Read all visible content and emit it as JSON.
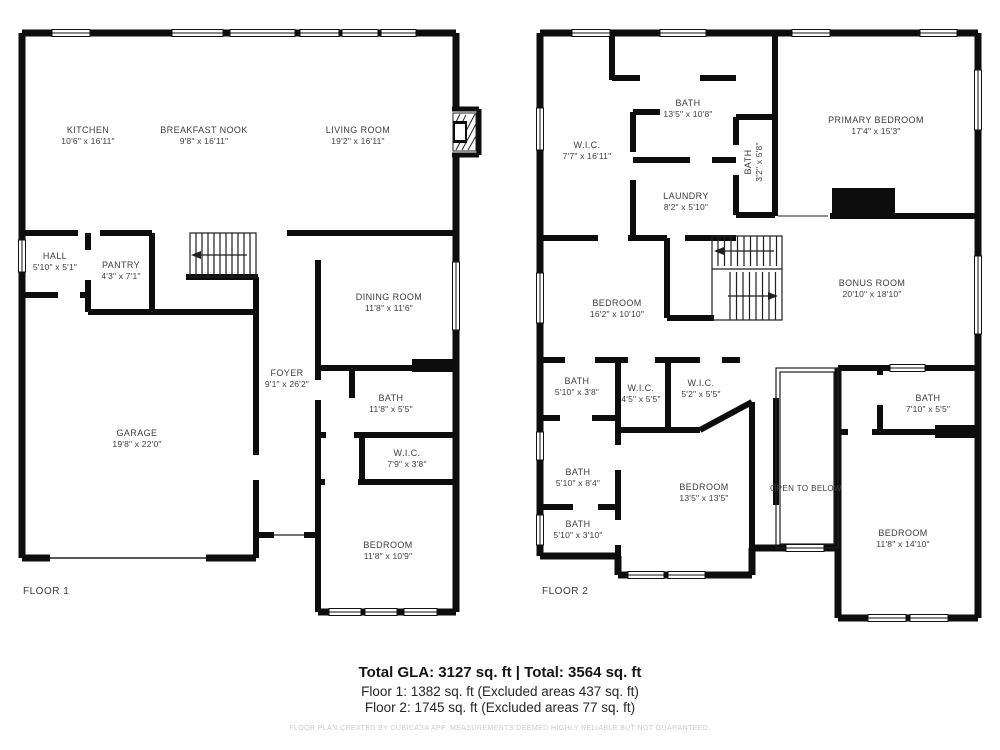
{
  "floor1": {
    "label": "FLOOR 1",
    "rooms": [
      {
        "name": "KITCHEN",
        "dims": "10'6\" x 16'11\""
      },
      {
        "name": "BREAKFAST NOOK",
        "dims": "9'8\" x 16'11\""
      },
      {
        "name": "LIVING ROOM",
        "dims": "19'2\" x 16'11\""
      },
      {
        "name": "HALL",
        "dims": "5'10\" x 5'1\""
      },
      {
        "name": "PANTRY",
        "dims": "4'3\" x 7'1\""
      },
      {
        "name": "DINING ROOM",
        "dims": "11'8\" x 11'6\""
      },
      {
        "name": "FOYER",
        "dims": "9'1\" x 26'2\""
      },
      {
        "name": "BATH",
        "dims": "11'8\" x 5'5\""
      },
      {
        "name": "W.I.C.",
        "dims": "7'9\" x 3'8\""
      },
      {
        "name": "GARAGE",
        "dims": "19'8\" x 22'0\""
      },
      {
        "name": "BEDROOM",
        "dims": "11'8\" x 10'9\""
      }
    ]
  },
  "floor2": {
    "label": "FLOOR 2",
    "open_to_below": "OPEN TO BELOW",
    "rooms": [
      {
        "name": "W.I.C.",
        "dims": "7'7\" x 16'11\""
      },
      {
        "name": "BATH",
        "dims": "13'5\" x 10'8\""
      },
      {
        "name": "BATH",
        "dims": "3'2\" x 5'8\""
      },
      {
        "name": "LAUNDRY",
        "dims": "8'2\" x 5'10\""
      },
      {
        "name": "PRIMARY BEDROOM",
        "dims": "17'4\" x 15'3\""
      },
      {
        "name": "BEDROOM",
        "dims": "16'2\" x 10'10\""
      },
      {
        "name": "BONUS ROOM",
        "dims": "20'10\" x 18'10\""
      },
      {
        "name": "BATH",
        "dims": "5'10\" x 3'8\""
      },
      {
        "name": "W.I.C.",
        "dims": "4'5\" x 5'5\""
      },
      {
        "name": "W.I.C.",
        "dims": "5'2\" x 5'5\""
      },
      {
        "name": "BATH",
        "dims": "5'10\" x 8'4\""
      },
      {
        "name": "BATH",
        "dims": "5'10\" x 3'10\""
      },
      {
        "name": "BEDROOM",
        "dims": "13'5\" x 13'5\""
      },
      {
        "name": "BATH",
        "dims": "7'10\" x 5'5\""
      },
      {
        "name": "BEDROOM",
        "dims": "11'8\" x 14'10\""
      }
    ]
  },
  "footer": {
    "total": "Total GLA: 3127 sq. ft | Total: 3564 sq. ft",
    "floor1_line": "Floor 1: 1382 sq. ft (Excluded areas 437 sq. ft)",
    "floor2_line": "Floor 2: 1745 sq. ft (Excluded areas 77 sq. ft)",
    "disclaimer": "FLOOR PLAN CREATED BY CUBICASA APP. MEASUREMENTS DEEMED HIGHLY RELIABLE BUT NOT GUARANTEED."
  },
  "colors": {
    "wall": "#0d0d0d",
    "thin": "#1f1f1f",
    "text": "#3d3d3d",
    "faint": "#cbcbcb"
  }
}
